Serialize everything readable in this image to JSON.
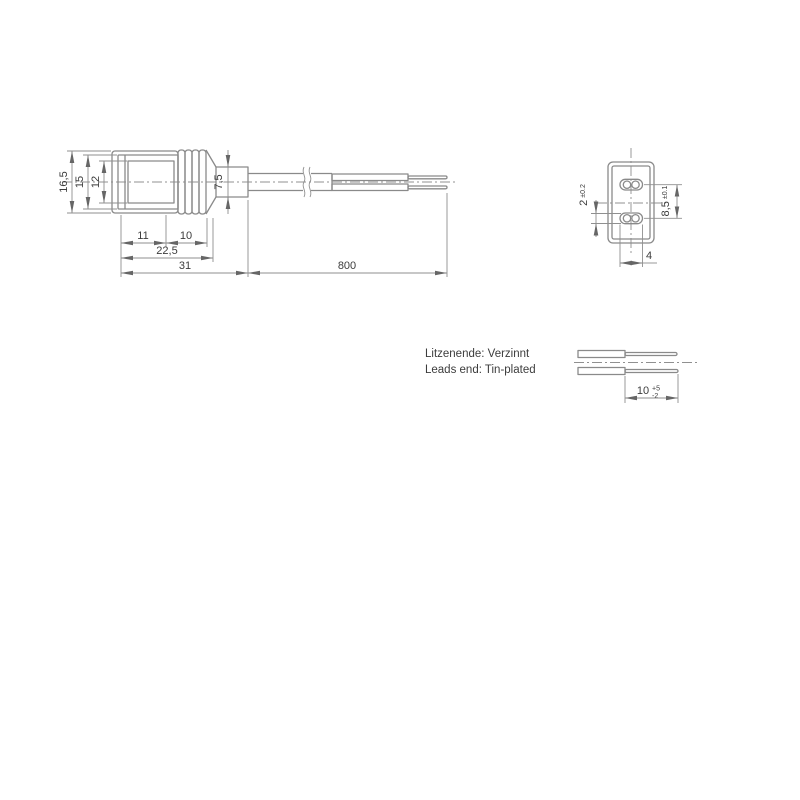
{
  "side_view": {
    "heights": {
      "outer": "16,5",
      "body": "15",
      "face": "12"
    },
    "lengths": {
      "front": "11",
      "ribs": "10",
      "body": "22,5",
      "head": "31",
      "cable": "800"
    },
    "gland_diameter": "7,5"
  },
  "face_view": {
    "slot_height": "2",
    "slot_height_tol": "±0.2",
    "slot_pitch": "8,5",
    "slot_pitch_tol": "±0.1",
    "slot_width": "4"
  },
  "leads_view": {
    "note_de": "Litzenende: Verzinnt",
    "note_en": "Leads end: Tin-plated",
    "tinned_length": "10",
    "tol_plus": "+5",
    "tol_minus": "-2"
  },
  "colors": {
    "line": "#8a8a8a",
    "text": "#3c3c3c",
    "background": "#ffffff"
  }
}
